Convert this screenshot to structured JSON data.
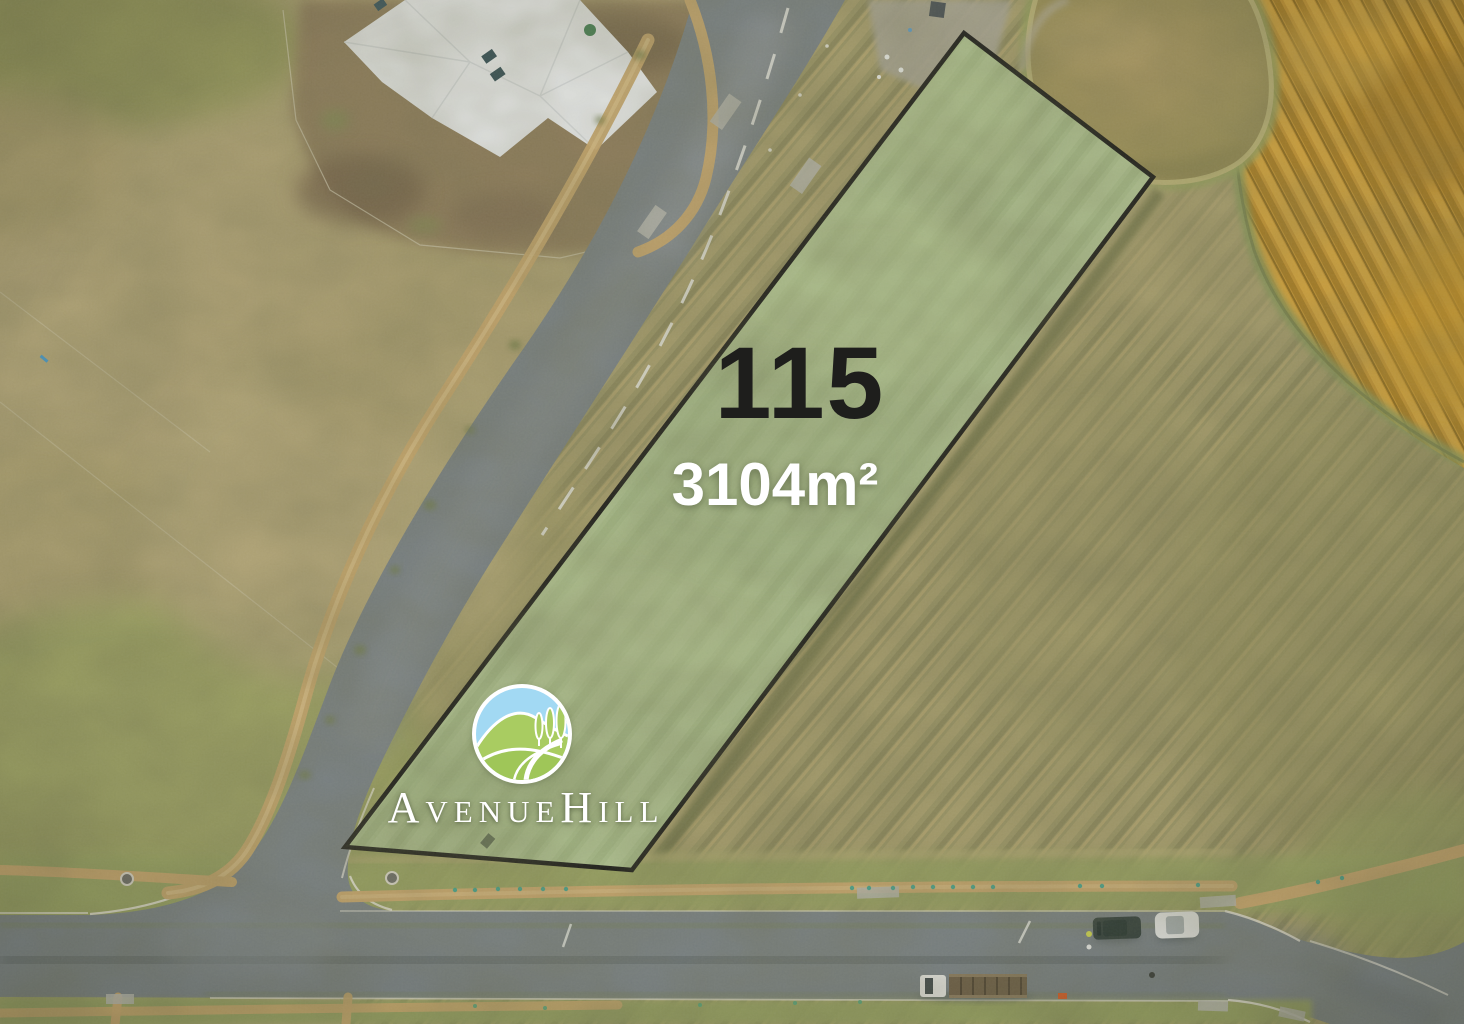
{
  "image": {
    "type": "aerial-drone-photo",
    "description": "Aerial view of a vacant residential land lot outlined in black within a rural estate"
  },
  "lot": {
    "number": "115",
    "area": "3104m²"
  },
  "brand": {
    "name": "AvenueHill"
  },
  "icons": {
    "logo": "avenuehill-logo-icon"
  },
  "colors": {
    "lot_highlight": "#a9bd8b",
    "lot_boundary": "#121212",
    "lot_number_text": "#1e1e1c",
    "lot_area_text": "#ffffff",
    "brand_text": "#ffffff",
    "logo_sky": "#a2d9f3",
    "logo_hill": "#a9cc61",
    "crop_field": "#c5922e",
    "pond_water": "#a39158",
    "asphalt_road": "#788086",
    "gravel_path": "#c8a66c"
  }
}
